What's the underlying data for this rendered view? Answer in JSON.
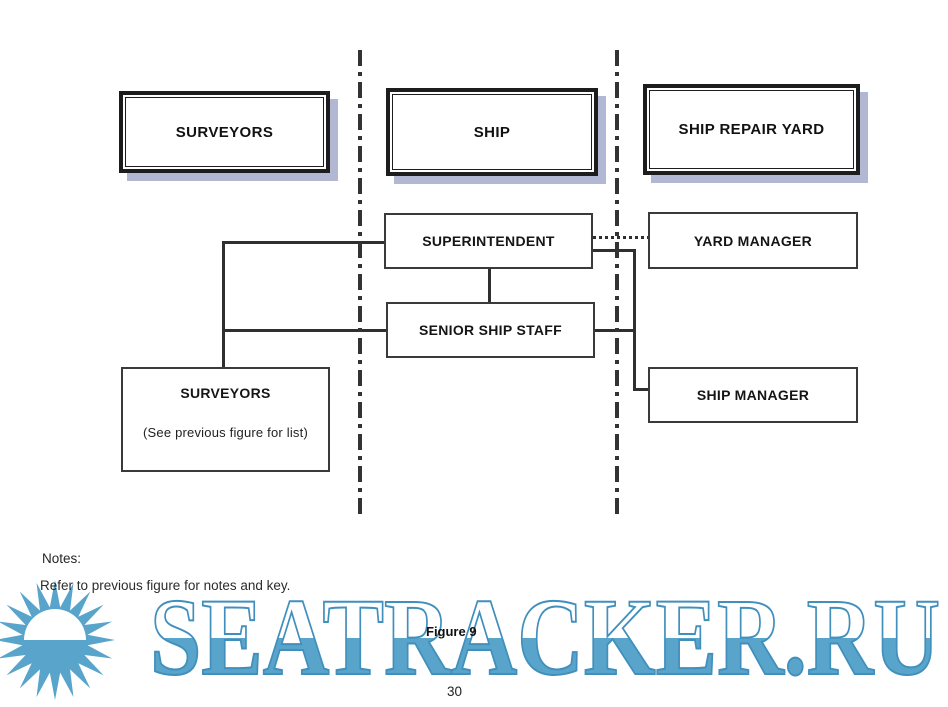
{
  "page": {
    "figure_caption": "Figure 9",
    "page_number": "30"
  },
  "notes": {
    "heading": "Notes:",
    "body": "Refer to previous figure for notes and key."
  },
  "diagram": {
    "columns": [
      {
        "id": "surveyors",
        "label": "SURVEYORS"
      },
      {
        "id": "ship",
        "label": "SHIP"
      },
      {
        "id": "ship-repair-yard",
        "label": "SHIP REPAIR YARD"
      }
    ],
    "nodes": [
      {
        "id": "superintendent",
        "label": "SUPERINTENDENT",
        "column": "ship"
      },
      {
        "id": "senior-ship-staff",
        "label": "SENIOR SHIP STAFF",
        "column": "ship"
      },
      {
        "id": "yard-manager",
        "label": "YARD MANAGER",
        "column": "ship-repair-yard"
      },
      {
        "id": "ship-manager",
        "label": "SHIP MANAGER",
        "column": "ship-repair-yard"
      },
      {
        "id": "surveyors-group",
        "label": "SURVEYORS",
        "sublabel": "(See previous figure for list)",
        "column": "surveyors"
      }
    ],
    "edges": [
      {
        "from": "superintendent",
        "to": "surveyors-group",
        "style": "solid"
      },
      {
        "from": "senior-ship-staff",
        "to": "surveyors-group",
        "style": "solid"
      },
      {
        "from": "superintendent",
        "to": "senior-ship-staff",
        "style": "solid"
      },
      {
        "from": "superintendent",
        "to": "yard-manager",
        "style": "dotted"
      },
      {
        "from": "superintendent",
        "to": "ship-manager",
        "style": "solid"
      },
      {
        "from": "senior-ship-staff",
        "to": "ship-manager",
        "style": "solid"
      }
    ]
  },
  "watermark": {
    "text": "SEATRACKER.RU",
    "color": "#58a4cb"
  },
  "colors": {
    "line": "#2f2f2f",
    "header_shadow": "#b2b8d4",
    "watermark_blue": "#58a4cb",
    "watermark_outline": "#418fbc"
  }
}
